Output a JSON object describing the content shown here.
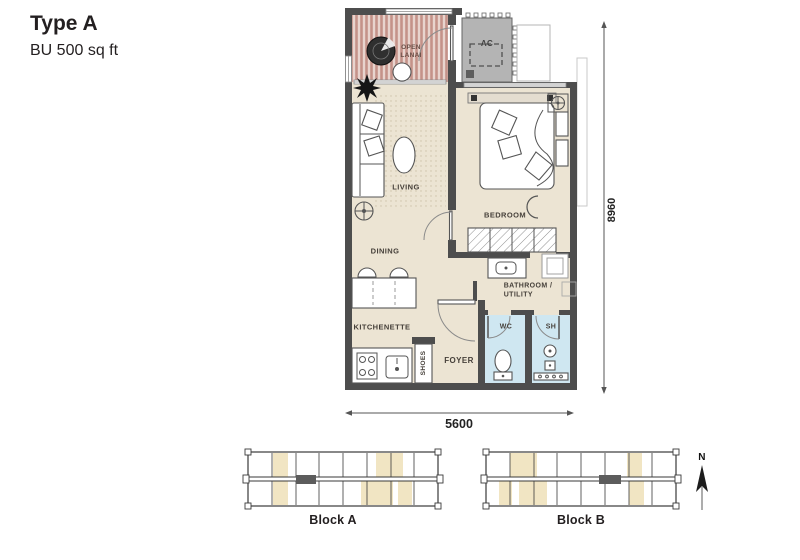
{
  "header": {
    "title": "Type A",
    "subtitle": "BU 500 sq ft"
  },
  "floor_plan": {
    "rooms": {
      "open_lanai": "OPEN\nLANAI",
      "ac": "AC",
      "living": "LIVING",
      "bedroom": "BEDROOM",
      "dining": "DINING",
      "kitchenette": "KITCHENETTE",
      "bathroom_utility": "BATHROOM /\nUTILITY",
      "wc": "WC",
      "sh": "SH",
      "foyer": "FOYER",
      "shoes": "SHOES"
    },
    "dimensions": {
      "height_mm": "8960",
      "width_mm": "5600"
    },
    "colors": {
      "floor": "#ece4d3",
      "deck_base": "#e8d4ce",
      "deck_stripe": "#c49289",
      "wall": "#4d4d4d",
      "wet_area": "#cfe7f1",
      "ac_ledge": "#b4b4b4",
      "unit_highlight": "#f1e5c3"
    }
  },
  "site_plan": {
    "block_a_label": "Block A",
    "block_b_label": "Block B",
    "north_label": "N"
  }
}
